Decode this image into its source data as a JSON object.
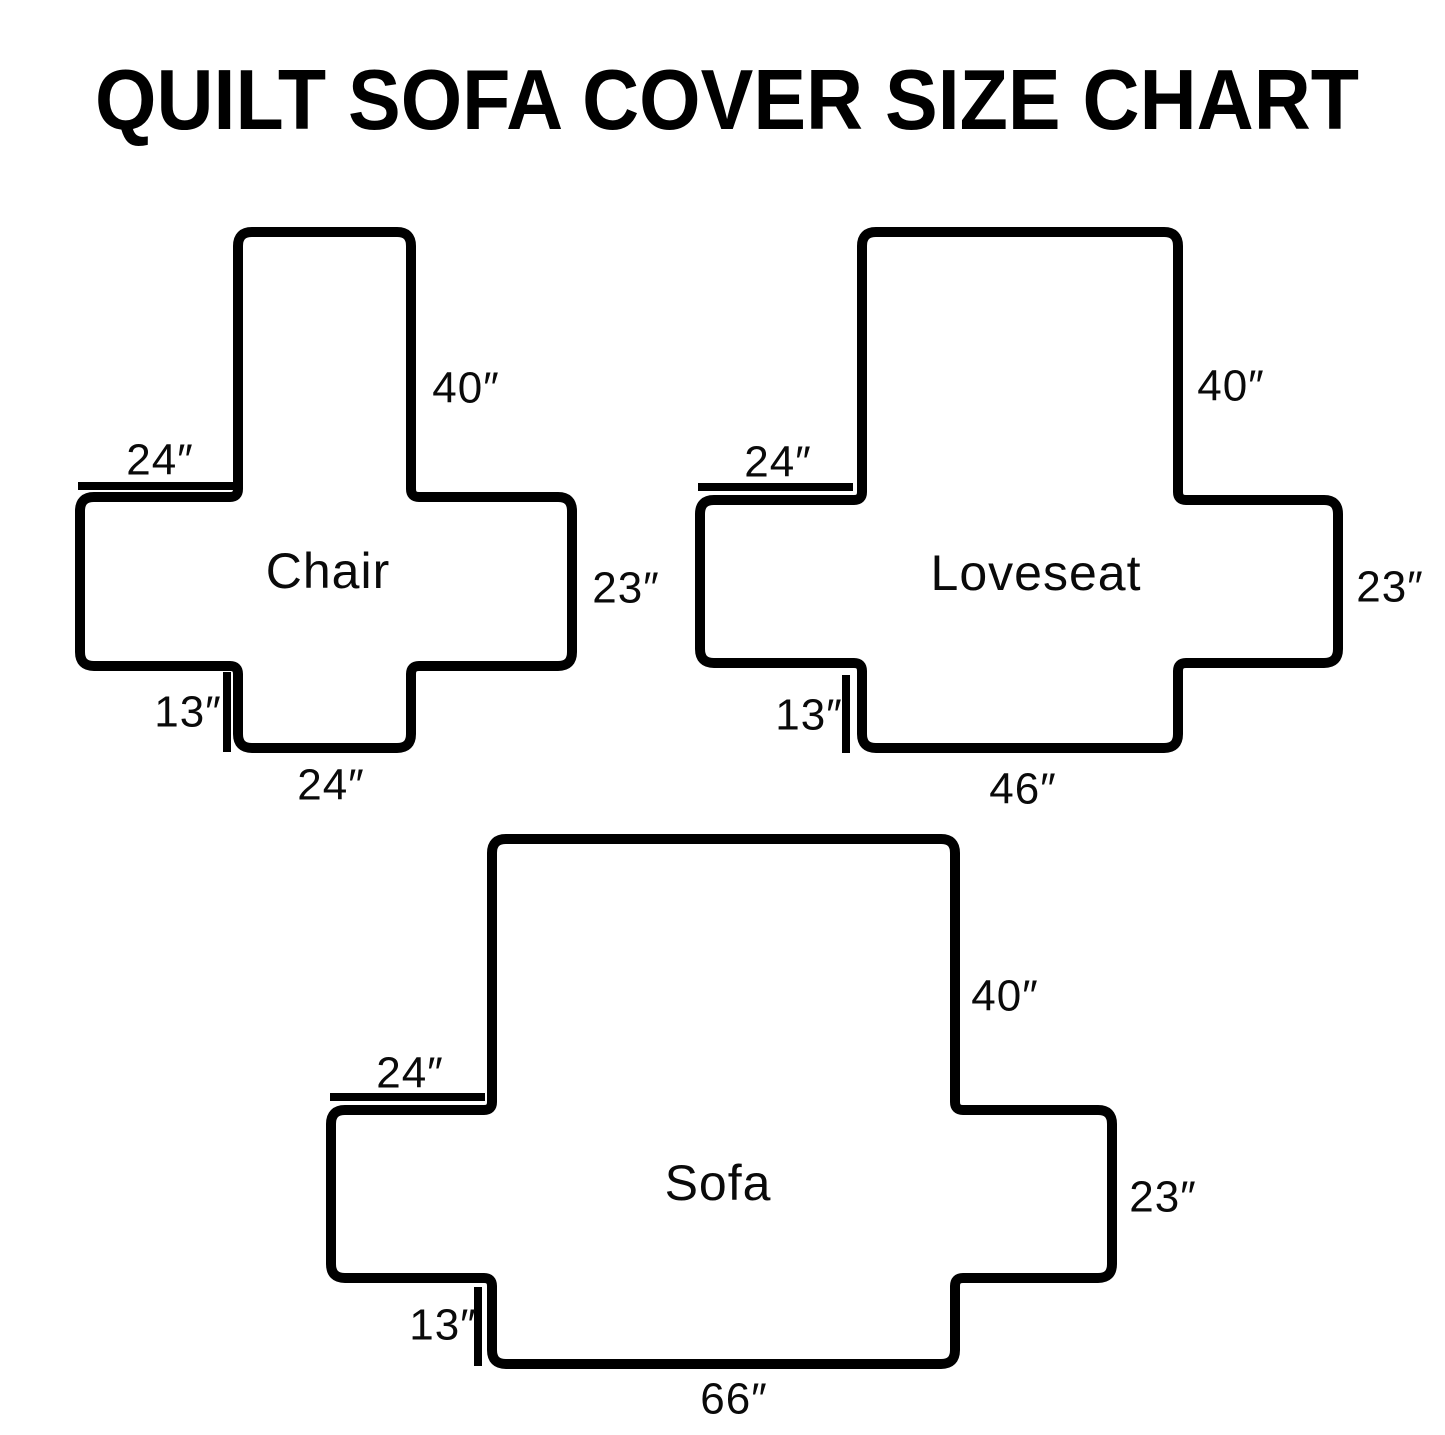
{
  "page": {
    "title": "QUILT SOFA COVER SIZE CHART",
    "background_color": "#ffffff",
    "line_color": "#000000"
  },
  "diagrams": {
    "chair": {
      "name": "Chair",
      "back_length": "40″",
      "arm_width": "24″",
      "arm_height": "23″",
      "front_skirt": "13″",
      "seat_front_width": "24″"
    },
    "loveseat": {
      "name": "Loveseat",
      "back_length": "40″",
      "arm_width": "24″",
      "arm_height": "23″",
      "front_skirt": "13″",
      "seat_front_width": "46″"
    },
    "sofa": {
      "name": "Sofa",
      "back_length": "40″",
      "arm_width": "24″",
      "arm_height": "23″",
      "front_skirt": "13″",
      "seat_front_width": "66″"
    }
  }
}
